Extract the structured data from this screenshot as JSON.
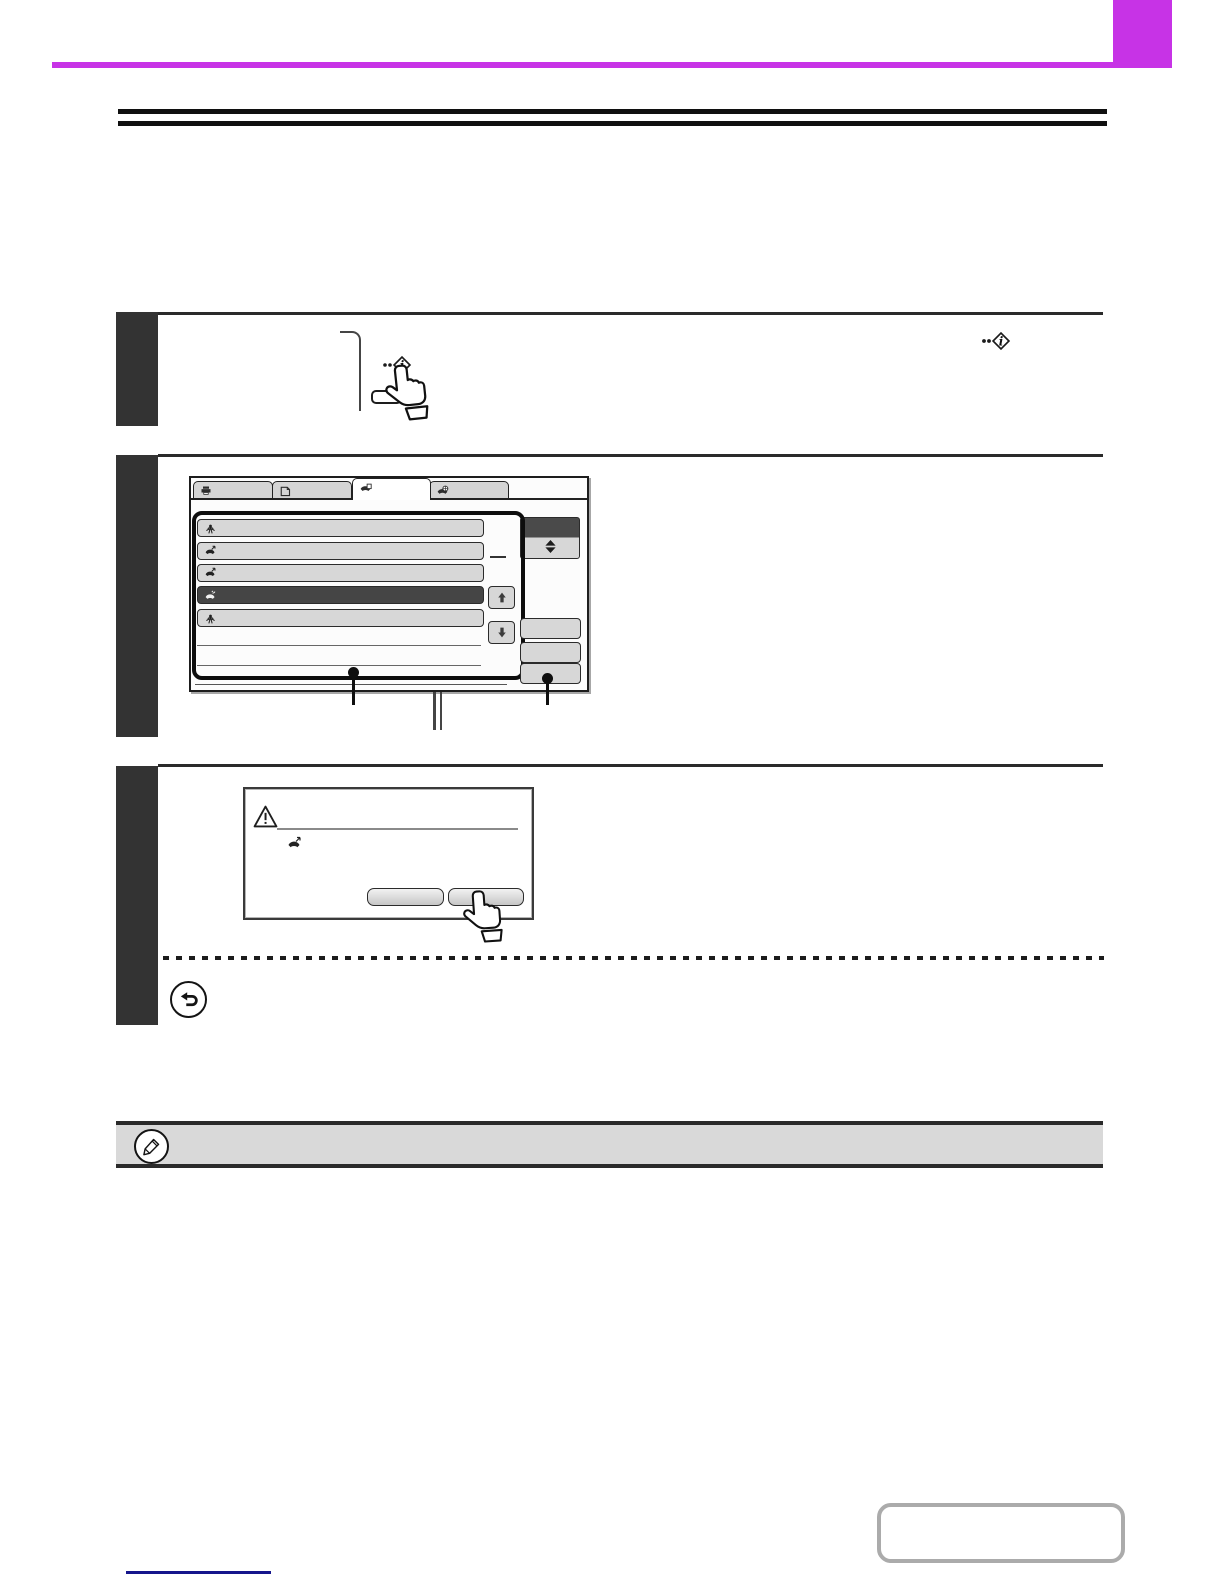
{
  "page": {
    "background": "#ffffff",
    "accent_magenta": "#c733e6",
    "step_bar_color": "#333333",
    "rule_color": "#101010",
    "note_background": "#d9d9d9",
    "link_line_color": "#16168c"
  },
  "header": {
    "accent_bar": "#c733e6",
    "accent_block": "#c733e6"
  },
  "title": {
    "double_rule_count": 2
  },
  "steps": [
    {
      "number": 1,
      "illustration": {
        "type": "operation-panel-sketch",
        "key_icon": "info-diamond-icon",
        "cursor": "hand-pointer-icon"
      },
      "inline_icon": "info-diamond-icon"
    },
    {
      "number": 2,
      "illustration": {
        "type": "touch-panel-screenshot"
      }
    },
    {
      "number": 3,
      "illustration": {
        "type": "confirmation-dialog"
      },
      "extras": [
        "dashed-divider",
        "return-arrow-icon"
      ]
    }
  ],
  "touch_screen": {
    "tabs": [
      {
        "icon": "printer-icon",
        "selected": false
      },
      {
        "icon": "scan-send-icon",
        "selected": false
      },
      {
        "icon": "fax-job-icon",
        "selected": true
      },
      {
        "icon": "internet-fax-icon",
        "selected": false
      }
    ],
    "job_list": {
      "rows": [
        {
          "icon": "broadcast-icon",
          "selected": false
        },
        {
          "icon": "outgoing-call-icon",
          "selected": false
        },
        {
          "icon": "outgoing-call-icon",
          "selected": false
        },
        {
          "icon": "speaker-call-icon",
          "selected": true
        },
        {
          "icon": "broadcast-icon",
          "selected": false
        }
      ],
      "empty_separator_count": 2,
      "highlight_frame": true
    },
    "scroll_buttons": {
      "up": "arrow-up-icon",
      "down": "arrow-down-icon"
    },
    "sort_button": {
      "icon": "double-triangle-icon",
      "top_half_color": "#4a4a4a"
    },
    "side_button_count": 3,
    "callout_count": 2,
    "row_selected_color": "#454545",
    "button_color": "#d7d7d7"
  },
  "dialog": {
    "warning_icon": "warning-triangle-icon",
    "job_icon": "outgoing-call-icon",
    "button_count": 2,
    "cursor": "hand-pointer-icon"
  },
  "note": {
    "icon": "pencil-icon",
    "background": "#d9d9d9"
  },
  "footer": {
    "contents_button": {
      "label": "",
      "border_color": "#ababab"
    },
    "link_line_color": "#16168c"
  }
}
